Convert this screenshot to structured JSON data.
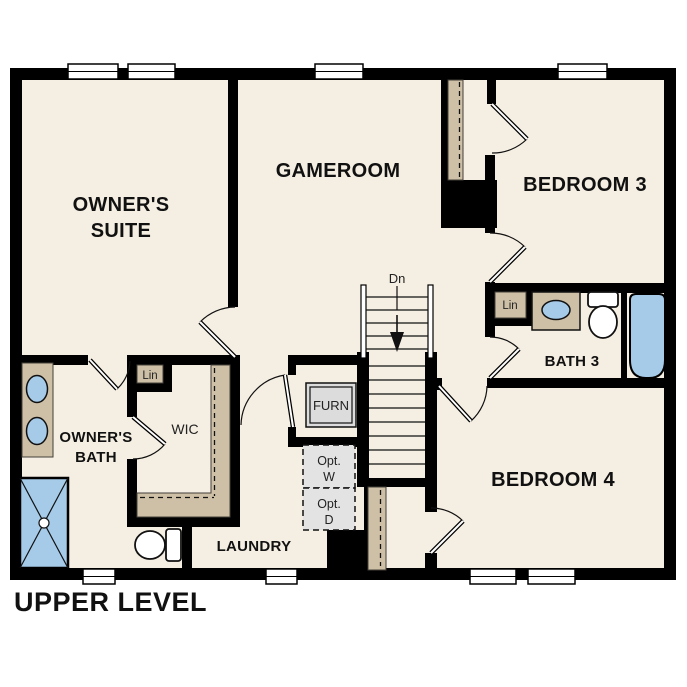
{
  "plan_title": "UPPER LEVEL",
  "colors": {
    "floor": "#f5eee2",
    "wall": "#000000",
    "cabinet_tan": "#cec0a6",
    "fixture_blue": "#a6cbe9",
    "optional_gray": "#e3e3e3",
    "furnace_gray": "#dcdcdc",
    "label_text": "#111111"
  },
  "rooms": {
    "owners_suite": {
      "line1": "OWNER'S",
      "line2": "SUITE"
    },
    "gameroom": {
      "label": "GAMEROOM"
    },
    "bedroom3": {
      "label": "BEDROOM 3"
    },
    "bedroom4": {
      "label": "BEDROOM 4"
    },
    "owners_bath": {
      "line1": "OWNER'S",
      "line2": "BATH"
    },
    "wic": {
      "label": "WIC"
    },
    "laundry": {
      "label": "LAUNDRY"
    },
    "bath3": {
      "label": "BATH 3"
    },
    "furnace_closet": {
      "label": "FURN"
    }
  },
  "closets": {
    "owners_linen": "Lin",
    "bath3_linen": "Lin"
  },
  "appliances": {
    "opt_washer_line1": "Opt.",
    "opt_washer_line2": "W",
    "opt_dryer_line1": "Opt.",
    "opt_dryer_line2": "D"
  },
  "stairs": {
    "direction_label": "Dn"
  }
}
